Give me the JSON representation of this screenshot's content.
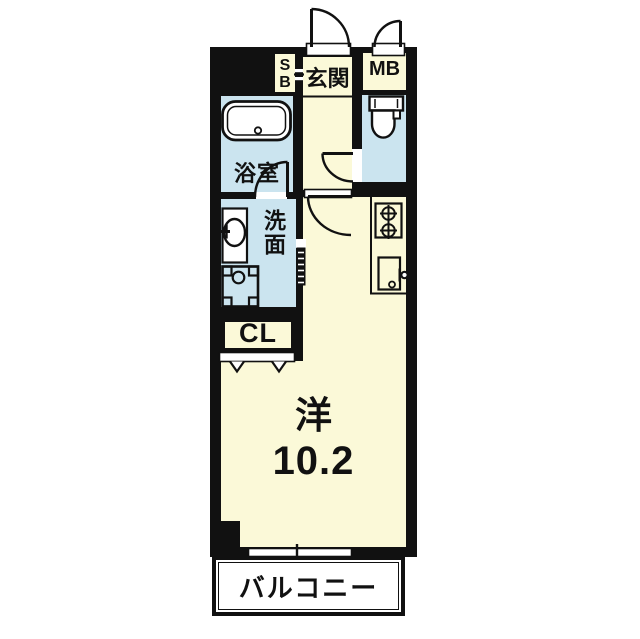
{
  "floorplan": {
    "rooms": {
      "entrance": {
        "label": "玄関"
      },
      "shoe_box": {
        "label": "SB"
      },
      "meter_box": {
        "label": "MB"
      },
      "bathroom": {
        "label": "浴室"
      },
      "washroom": {
        "label": "洗面"
      },
      "closet": {
        "label": "CL"
      },
      "western_room": {
        "label": "洋",
        "area": "10.2"
      },
      "balcony": {
        "label": "バルコニー"
      }
    },
    "colors": {
      "floor_cream": "#FBF9D8",
      "wet_area_blue": "#CBE4EF",
      "wall": "#111111",
      "outside": "#FFFFFF"
    },
    "fixtures": [
      "bathtub",
      "wash-basin",
      "washing-machine-pan",
      "toilet",
      "gas-stove-2-burner",
      "kitchen-sink",
      "entrance-door",
      "meter-box-door",
      "bathroom-door",
      "toilet-door",
      "room-door",
      "folding-door",
      "sliding-window",
      "closet-doors"
    ]
  }
}
